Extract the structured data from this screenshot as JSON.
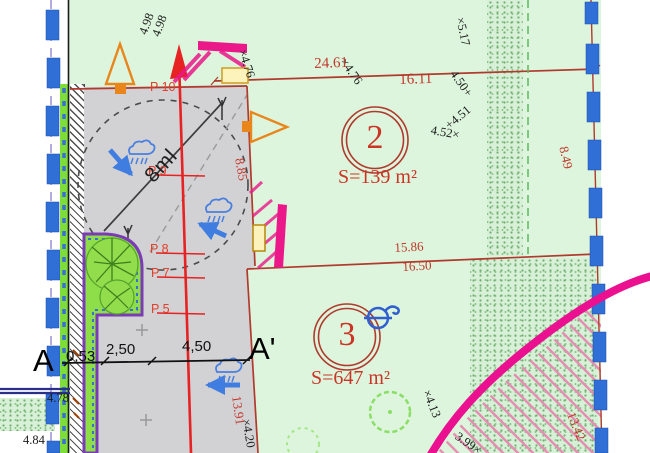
{
  "plan": {
    "section_marks": {
      "start": "A",
      "end": "A'"
    },
    "section_dims": [
      "0,53",
      "2,50",
      "4,50"
    ],
    "turning_radius_label": "8ml",
    "parcels": [
      {
        "number": "2",
        "area": "S=139 m²"
      },
      {
        "number": "3",
        "area": "S=647 m²"
      }
    ],
    "survey_points": [
      "P 10",
      "P 9",
      "P 8",
      "P 7",
      "P 5"
    ],
    "boundary_dims": [
      "24.61",
      "16.11",
      "15.86",
      "16.50",
      "8.85",
      "8.49",
      "13.42",
      "13.91"
    ],
    "spot_elevations": [
      "4.98",
      "4.98",
      "×4.76",
      "×4.76",
      "4.50+",
      "+4.51",
      "4.52×",
      "×5.17",
      "×4.13",
      "3.99×",
      "×4.20",
      "4.78",
      "4.84"
    ],
    "colors": {
      "plan_green": "#dcf5dc",
      "parcel_gray": "#d2d2d4",
      "boundary_red": "#b03a2e",
      "survey_red": "#e62222",
      "magenta": "#ea1090",
      "marker_blue": "#2f6fd6",
      "lime": "#7fdd3a",
      "garden_purple": "#7a3bb5",
      "arrow_blue": "#3f7de0",
      "symbol_orange": "#e8861c",
      "yellow_fill": "#fcf3bc"
    }
  }
}
